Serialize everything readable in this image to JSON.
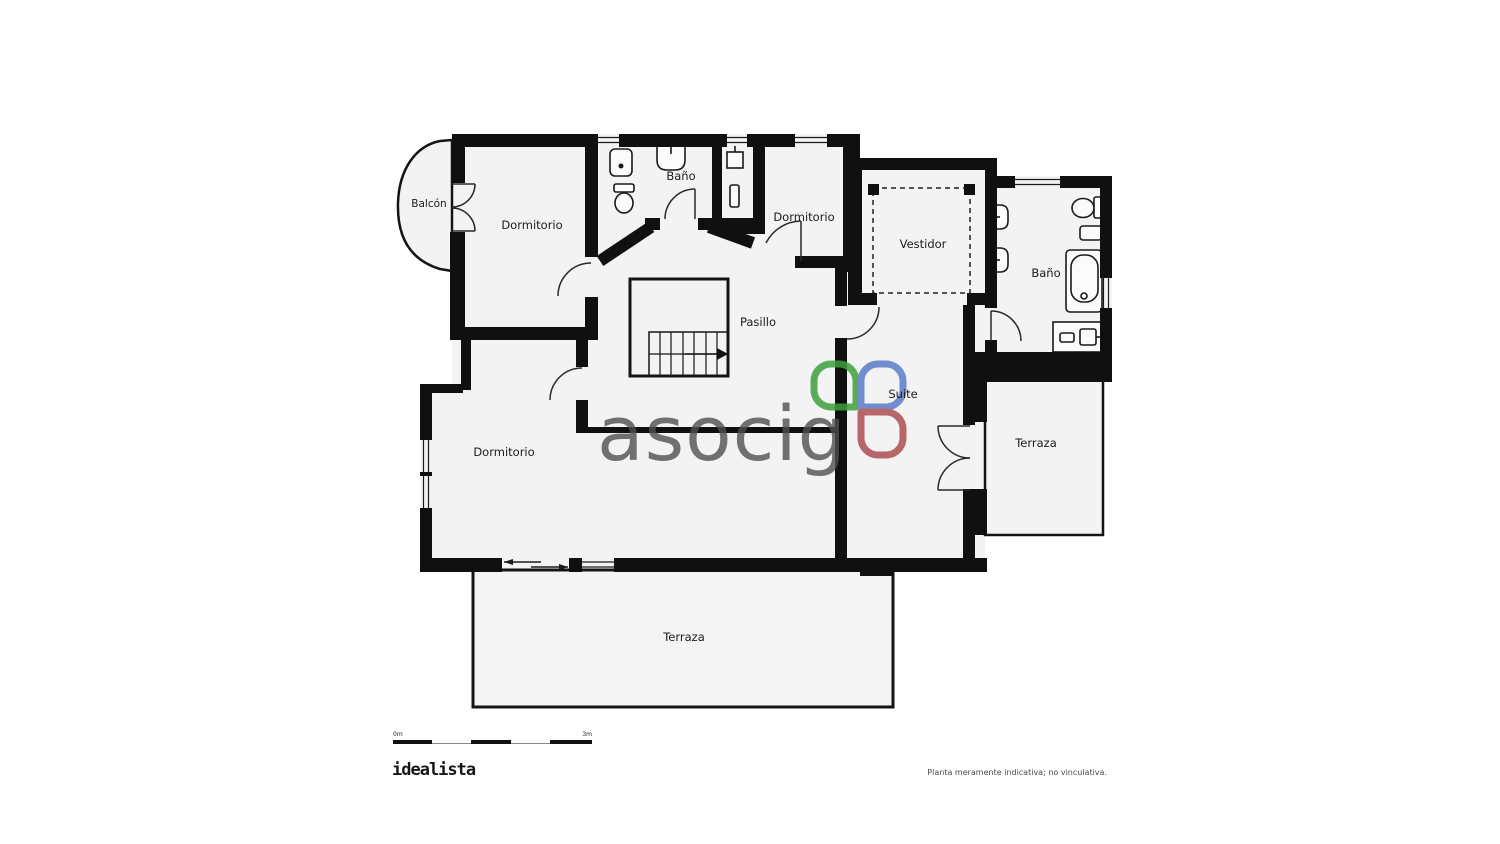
{
  "page": {
    "background": "#ffffff"
  },
  "plan": {
    "colors": {
      "wall": "#101010",
      "room_fill": "#f3f3f3",
      "line": "#1a1a1a"
    },
    "rooms": [
      {
        "id": "balcon",
        "label": "Balcón"
      },
      {
        "id": "dormitorio-top-left",
        "label": "Dormitorio"
      },
      {
        "id": "bano-top",
        "label": "Baño"
      },
      {
        "id": "dormitorio-top-right",
        "label": "Dormitorio"
      },
      {
        "id": "vestidor",
        "label": "Vestidor"
      },
      {
        "id": "bano-right",
        "label": "Baño"
      },
      {
        "id": "pasillo",
        "label": "Pasillo"
      },
      {
        "id": "suite",
        "label": "Suite"
      },
      {
        "id": "terraza-right",
        "label": "Terraza"
      },
      {
        "id": "dormitorio-left",
        "label": "Dormitorio"
      },
      {
        "id": "terraza-bottom",
        "label": "Terraza"
      }
    ]
  },
  "watermark": {
    "text": "asocig",
    "text_color": "#4f4f4f",
    "petal_green": "#3da03c",
    "petal_blue": "#5b7cc9",
    "petal_red": "#ad4f52"
  },
  "scale_bar": {
    "start_label": "0m",
    "end_label": "3m"
  },
  "footer": {
    "brand": "idealista",
    "disclaimer": "Planta meramente indicativa; no vinculativa."
  }
}
